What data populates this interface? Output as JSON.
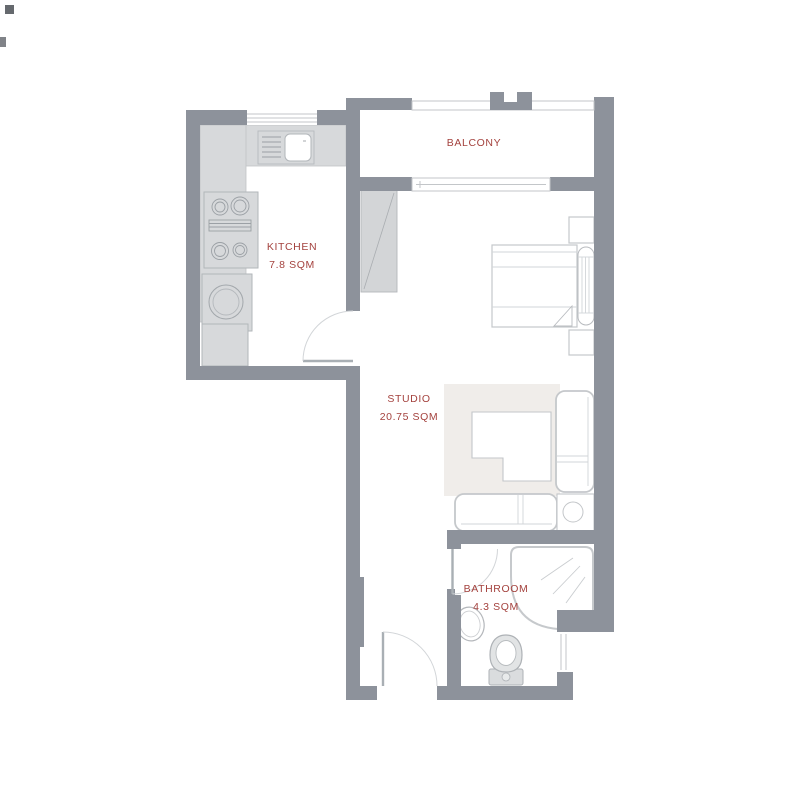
{
  "rooms": {
    "balcony": {
      "label": "BALCONY"
    },
    "kitchen": {
      "label": "KITCHEN",
      "area": "7.8 SQM"
    },
    "studio": {
      "label": "STUDIO",
      "area": "20.75 SQM"
    },
    "bathroom": {
      "label": "BATHROOM",
      "area": "4.3 SQM"
    }
  },
  "fixtures": [
    "kitchen-sink-icon",
    "stove-icon",
    "washing-machine-icon",
    "refrigerator-icon",
    "wardrobe-icon",
    "double-bed-icon",
    "pillow-icon",
    "nightstand-icon",
    "rug-icon",
    "coffee-table-icon",
    "corner-sofa-icon",
    "side-table-lamp-icon",
    "shower-icon",
    "washbasin-icon",
    "toilet-icon",
    "door-swing-icon",
    "sliding-door-icon",
    "window-icon",
    "balcony-railing-icon"
  ],
  "colors": {
    "wall": "#8d929b",
    "counter": "#d7d9db",
    "rug": "#f0edea",
    "furniture_outline": "#c5c8cb",
    "label_text": "#a4423e",
    "background": "#ffffff"
  }
}
